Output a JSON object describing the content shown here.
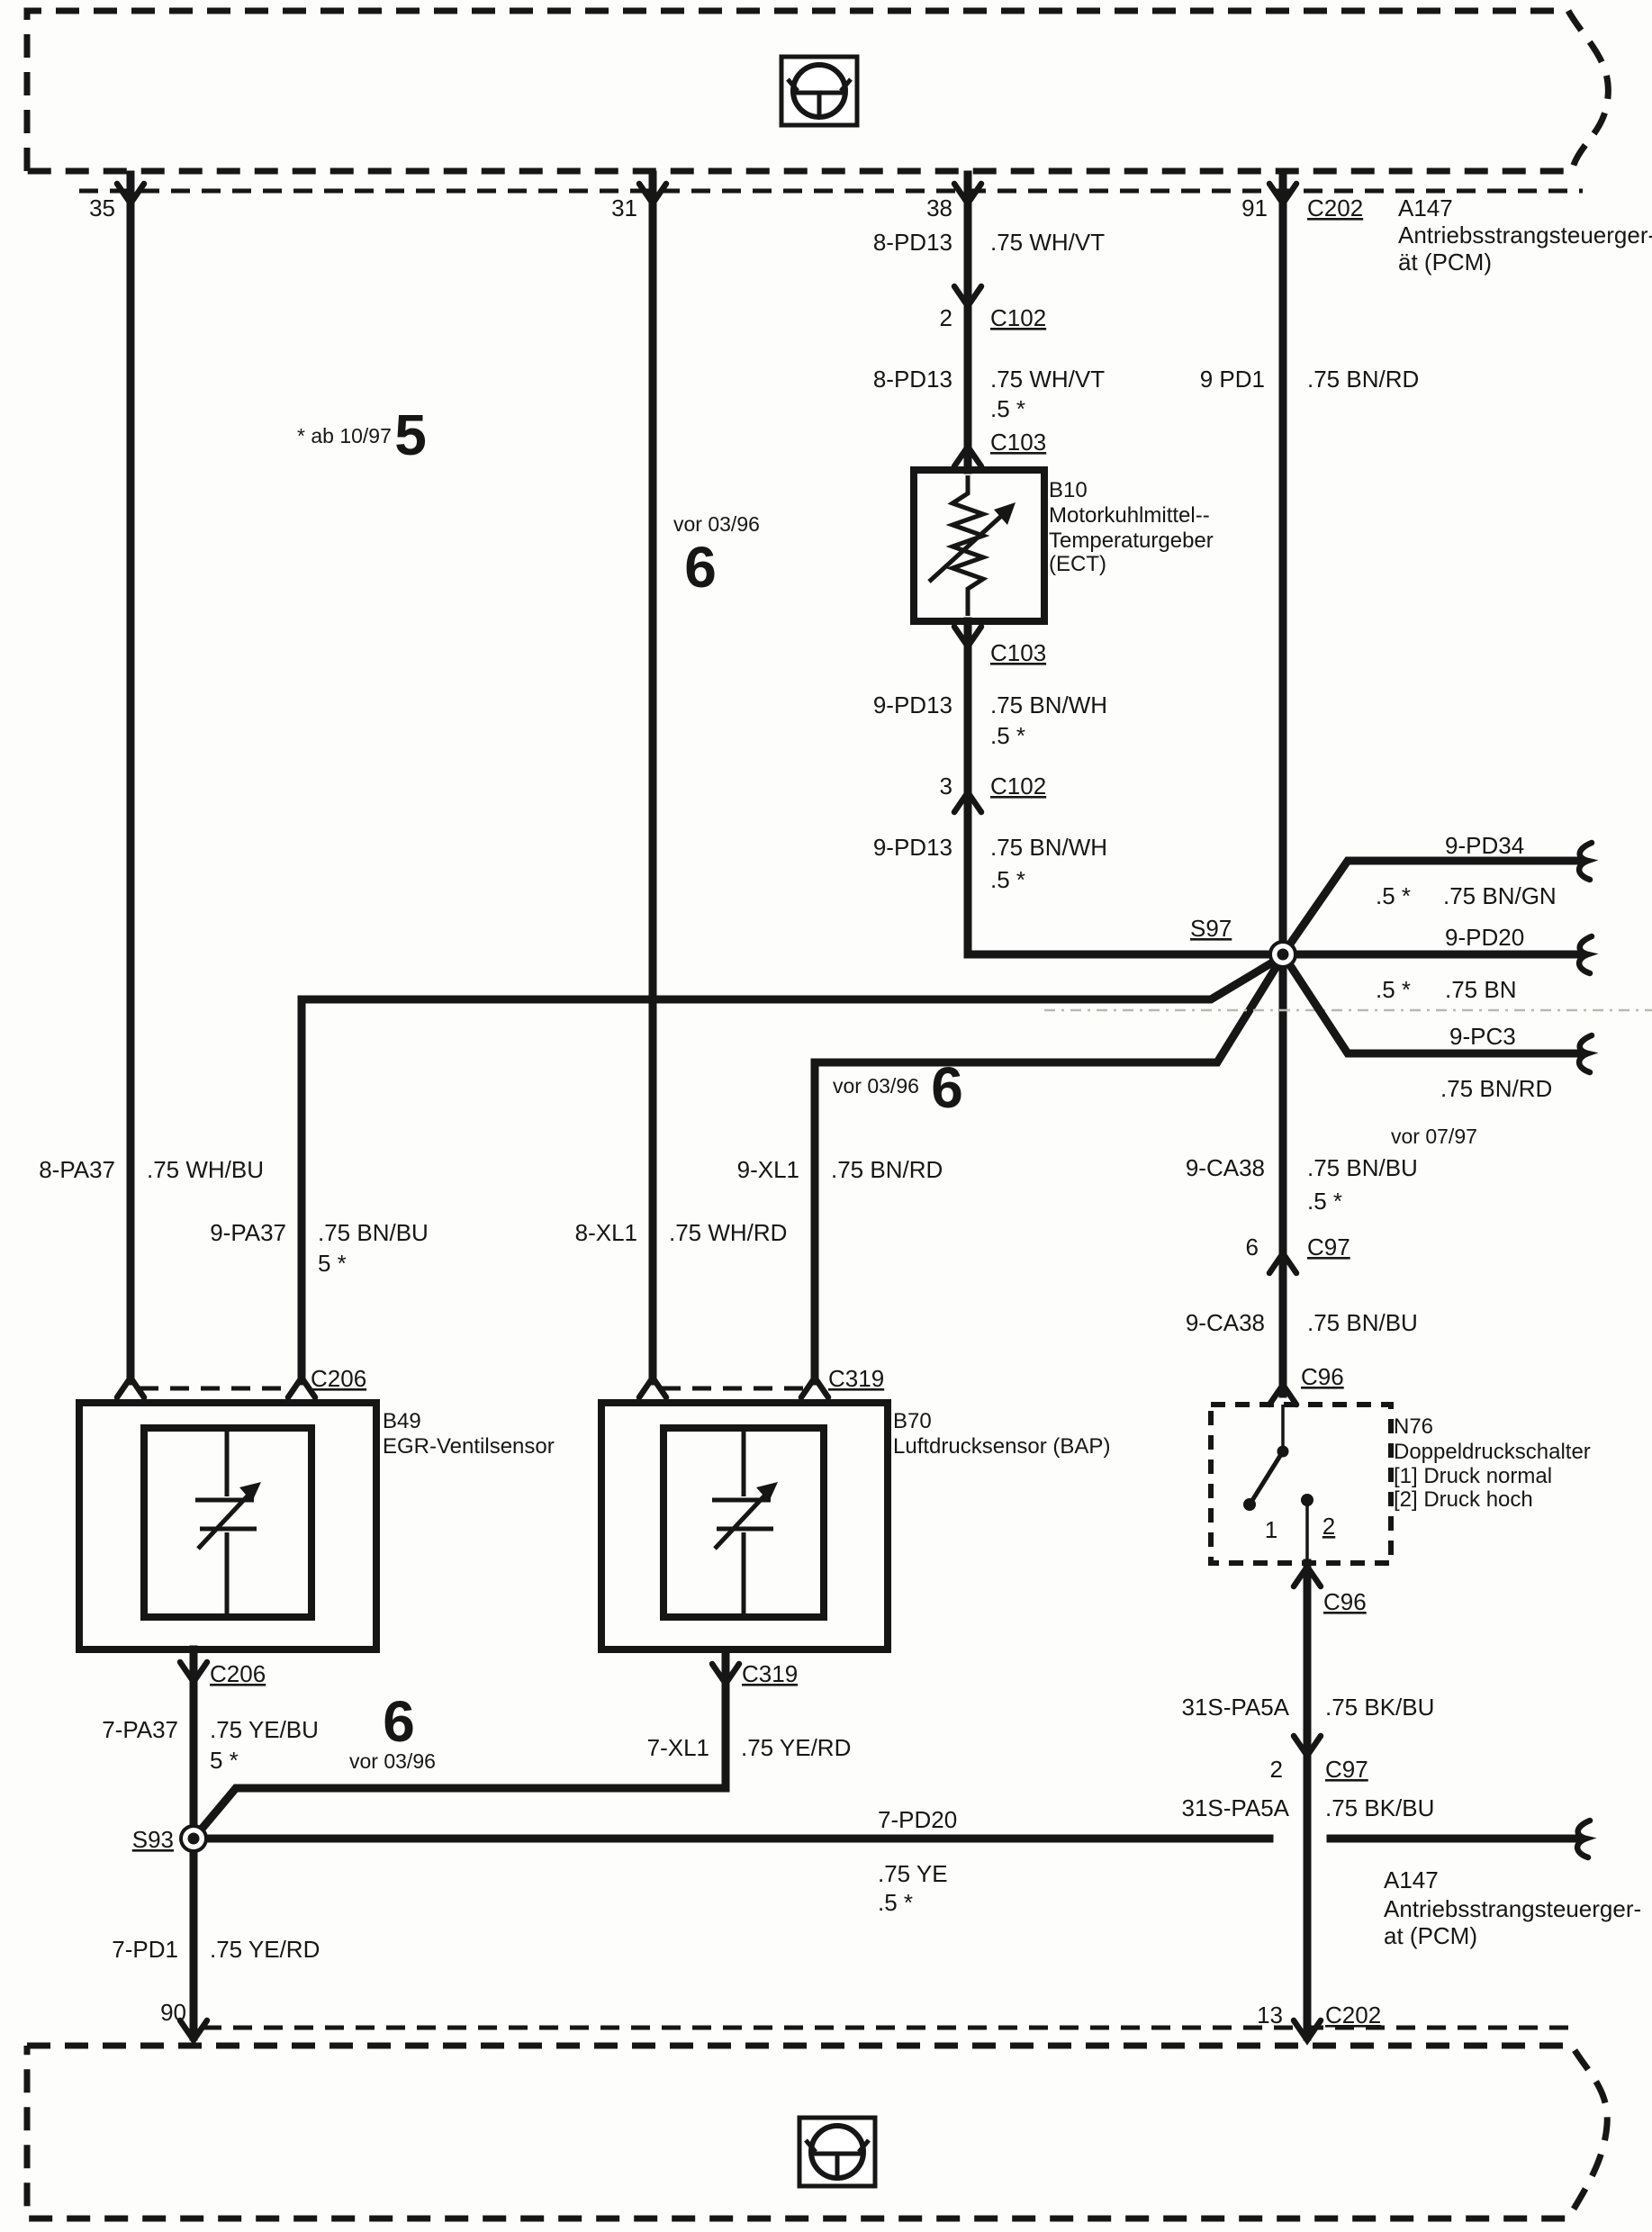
{
  "pcm_top": {
    "pin35": "35",
    "pin31": "31",
    "pin38": "38",
    "pin91": "91",
    "c202": "C202",
    "name": "A147",
    "desc1": "Antriebsstrangsteuerger-",
    "desc2": "ät (PCM)"
  },
  "notes": {
    "ab1097": "* ab 10/97",
    "num5": "5",
    "vor0396_a": "vor 03/96",
    "num6_a": "6",
    "vor0396_b": "vor 03/96",
    "num6_b": "6",
    "vor0396_c": "vor 03/96",
    "num6_c": "6",
    "vor0797": "vor 07/97"
  },
  "ect": {
    "seg1_code": "8-PD13",
    "seg1_color": ".75 WH/VT",
    "c102_top_pin": "2",
    "c102_top": "C102",
    "seg2_code": "8-PD13",
    "seg2_color": ".75 WH/VT",
    "seg2_size": ".5 *",
    "c103_top": "C103",
    "b10_id": "B10",
    "b10_l1": "Motorkuhlmittel--",
    "b10_l2": "Temperaturgeber",
    "b10_l3": "(ECT)",
    "c103_bot": "C103",
    "seg3_code": "9-PD13",
    "seg3_color": ".75 BN/WH",
    "seg3_size": ".5 *",
    "c102_bot_pin": "3",
    "c102_bot": "C102",
    "seg4_code": "9-PD13",
    "seg4_color": ".75 BN/WH",
    "seg4_size": ".5 *"
  },
  "pd1": {
    "code": "9 PD1",
    "color": ".75 BN/RD"
  },
  "s97": {
    "id": "S97",
    "pd34_code": "9-PD34",
    "pd34_size": ".5 *",
    "pd34_color": ".75 BN/GN",
    "pd20_code": "9-PD20",
    "pd20_size": ".5 *",
    "pd20_color": ".75 BN",
    "pc3_code": "9-PC3",
    "pc3_color": ".75 BN/RD"
  },
  "egr_wires": {
    "left_code": "8-PA37",
    "left_color": ".75 WH/BU",
    "right_code": "9-PA37",
    "right_color": ".75 BN/BU",
    "right_size": "5 *"
  },
  "bap_wires": {
    "left_code": "8-XL1",
    "left_color": ".75 WH/RD",
    "right_code": "9-XL1",
    "right_color": ".75 BN/RD"
  },
  "ca38": {
    "up_code": "9-CA38",
    "up_color": ".75 BN/BU",
    "up_size": ".5 *",
    "c97_pin": "6",
    "c97": "C97",
    "dn_code": "9-CA38",
    "dn_color": ".75 BN/BU",
    "c96": "C96"
  },
  "b49": {
    "c206_top": "C206",
    "id": "B49",
    "desc": "EGR-Ventilsensor",
    "c206_bot": "C206"
  },
  "b70": {
    "c319_top": "C319",
    "id": "B70",
    "desc": "Luftdrucksensor (BAP)",
    "c319_bot": "C319"
  },
  "n76": {
    "id": "N76",
    "desc": "Doppeldruckschalter",
    "state1": "[1] Druck normal",
    "state2": "[2] Druck hoch",
    "pin1": "1",
    "pin2": "2",
    "c96": "C96"
  },
  "s93": {
    "id": "S93"
  },
  "bottom_left": {
    "pa37_code": "7-PA37",
    "pa37_color": ".75 YE/BU",
    "pa37_size": "5 *",
    "xl1_code": "7-XL1",
    "xl1_color": ".75 YE/RD",
    "pd1_code": "7-PD1",
    "pd1_color": ".75 YE/RD",
    "pin90": "90"
  },
  "pd20_bot": {
    "code": "7-PD20",
    "color": ".75 YE",
    "size": ".5 *"
  },
  "pa5a": {
    "seg1_code": "31S-PA5A",
    "seg1_color": ".75 BK/BU",
    "c97_pin": "2",
    "c97": "C97",
    "seg2_code": "31S-PA5A",
    "seg2_color": ".75 BK/BU"
  },
  "pcm_bot": {
    "name": "A147",
    "desc1": "Antriebsstrangsteuerger-",
    "desc2": "at (PCM)",
    "pin13": "13",
    "c202": "C202"
  }
}
